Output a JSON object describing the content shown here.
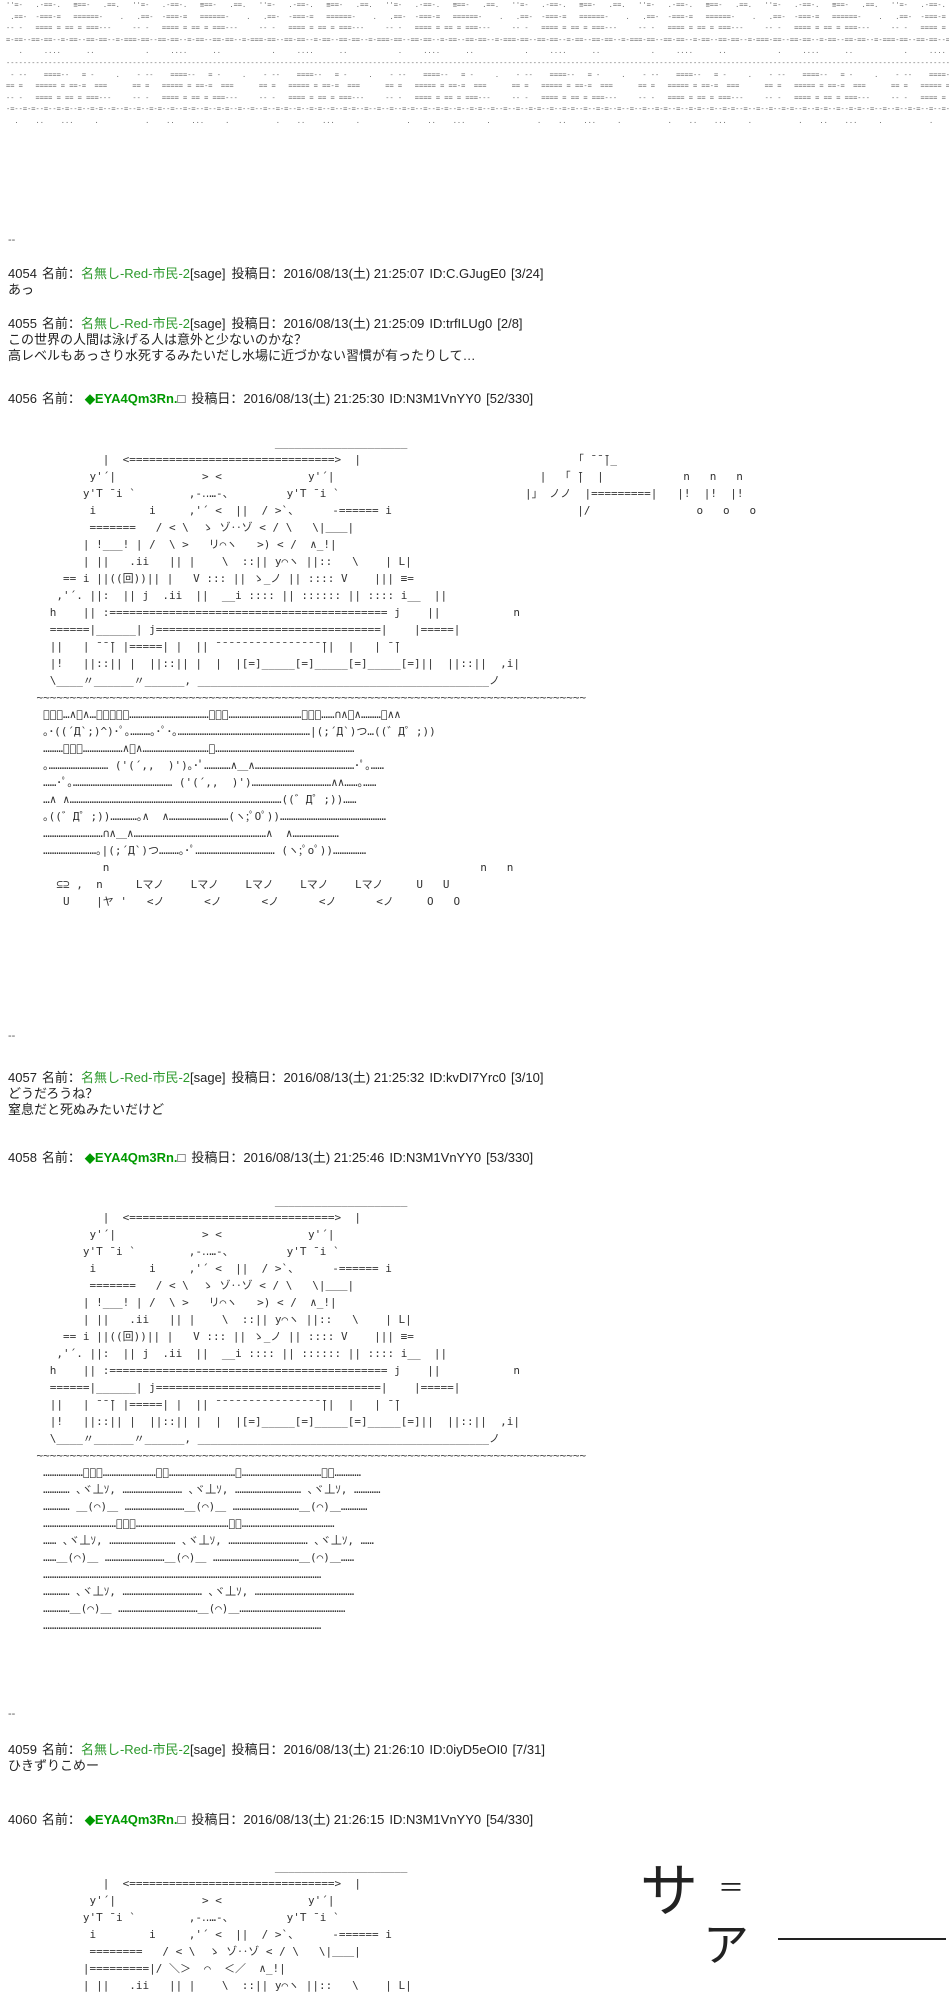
{
  "labels": {
    "name": "名前：",
    "date": "投稿日："
  },
  "separator": "--",
  "colors": {
    "name_green": "#2d9a2d",
    "trip_green": "#009900",
    "text": "#222222",
    "aa": "#333333",
    "background": "#ffffff"
  },
  "top_overflow_aa": "''=-   .-==-.   ≡==-   .==.   ''=-   .-==-.   ≡==-   .==.   ''=-   .-==-.   ≡==-   .==.   ''=-   .-==-.   ≡==-   .==.   ''=-   .-==-.   ≡==-   .==.   ''=-   .-==-.   ≡==-   .==.   ''=-   .-==-.   ≡==-   .==.   ''=-   .-==-.   ≡==-   .==.   \n .==-  -===-=   ======-    .   .==-  -===-=   ======-    .   .==-  -===-=   ======-    .   .==-  -===-=   ======-    .   .==-  -===-=   ======-    .   .==-  -===-=   ======-    .   .==-  -===-=   ======-    .   .==-  -===-=   ======-    .  \n-- -   ==== = == = ===---     -- -   ==== = == = ===---     -- -   ==== = == = ===---     -- -   ==== = == = ===---     -- -   ==== = == = ===---     -- -   ==== = == = ===---     -- -   ==== = == = ===---     -- -   ==== = == = ===---     \n=-==--==-==--=-==--==-==--=-===-==--==-==--=-==--==-==--=-===-==--==-==--=-==--==-==--=-===-==--==-==--=-==--==-==--=-===-==--==-==--=-==--==-==--=-===-==--==-==--=-==--==-==--=-===-==--==-==--=-==--==-==--=-===-==--==-==--=-==--==-==--=-==\n   .     ....      ..            .     ....      ..            .     ....      ..            .     ....      ..            .     ....      ..            .     ....      ..            .     ....      ..            .     ....      ..         \n------------------------------------------------------------------------------------------------------------------------------------------------------------------------------------------------------------------------------------------------\n - --    ====--   = -     .    - --    ====--   = -     .    - --    ====--   = -     .    - --    ====--   = -     .    - --    ====--   = -     .    - --    ====--   = -     .    - --    ====--   = -     .    - --    ====--   = -     .   \n== =   ===== = ==-=  ===      == =   ===== = ==-=  ===      == =   ===== = ==-=  ===      == =   ===== = ==-=  ===      == =   ===== = ==-=  ===      == =   ===== = ==-=  ===      == =   ===== = ==-=  ===      == =   ===== = ==-=  ===      \n-- -   ==== = == = ===---     -- -   ==== = == = ===---     -- -   ==== = == = ===---     -- -   ==== = == = ===---     -- -   ==== = == = ===---     -- -   ==== = == = ===---     -- -   ==== = == = ===---     -- -   ==== = == = ===---     \n-=--=-=--=--=-=--=--=-=--=--=--=--=-=--=--=-=--=--=-=--=--=--=--=-=--=--=-=--=--=-=--=--=--=--=-=--=--=-=--=--=-=--=--=--=--=-=--=--=-=--=--=-=--=--=--=--=-=--=--=-=--=--=-=--=--=--=--=-=--=--=-=--=--=-=--=--=--=--=-=--=--=-=--=--=-=--=--\n  .    ..    ...     .           .    ..    ...     .           .    ..    ...     .           .    ..    ...     .           .    ..    ...     .           .    ..    ...     .           .    ..    ...     .           .    ..    ...     .  ",
  "posts": [
    {
      "number": "4054",
      "name": "名無し-Red-市民-2",
      "name_suffix": "[sage]",
      "datetime": "2016/08/13(土) 21:25:07",
      "id": "ID:C.GJugE0",
      "count": "[3/24]",
      "body": "あっ"
    },
    {
      "number": "4055",
      "name": "名無し-Red-市民-2",
      "name_suffix": "[sage]",
      "datetime": "2016/08/13(土) 21:25:09",
      "id": "ID:trfILUg0",
      "count": "[2/8]",
      "body": "この世界の人間は泳げる人は意外と少ないのかな？\n高レベルもあっさり水死するみたいだし水場に近づかない習慣が有ったりして…"
    },
    {
      "number": "4056",
      "name": "◆EYA4Qm3Rn.",
      "name_suffix": "□",
      "datetime": "2016/08/13(土) 21:25:30",
      "id": "ID:N3M1VnYY0",
      "count": "[52/330]",
      "body": "                                        ____________________\n              |  <===============================>  |                                「 ̄ ̄ ̄|_\n            y'´|             > <             y'´|                               |  「 ̄|  |            n   n   n\n           y'T ̄ i `        ,-‥…-、        y'T ̄ i `                            |」 ノノ  |=========|   |!  |!  |!\n            i        i     ,'´ <  ||  / >`、     -====== i                            |/                o   o   o\n            =======   / < \\  ゝ ゾ‥ゾ < / \\   \\|＿＿|\n           | !___! | /  \\ >   リ⌒ヽ   >) < /  ∧_!|\n           | ||   .ii   || |    \\  ::|| y⌒ヽ ||::   \\    | L|\n        == i ||((回))|| |   V ::: || ゝ_ノ || :::: V    ||| ≡=\n       ,'´. ||:  || j  .ii  ||  __i :::: || :::::: || :::: i__  ||\n      h    || :========================================== j    ||           n\n      ======|______| j==================================|    |=====|\n      ||   | ̄ ̄ ̄| |=====| |  || ̄ ̄ ̄ ̄ ̄ ̄ ̄ ̄ ̄ ̄ ̄ ̄ ̄ ̄ ̄ ̄ ̄||  |   | ̄ ̄|\n      |!   ||::|| |  ||::|| |  |  |[=]_____[=]_____[=]_____[=]||  ||::||  ,i|\n      \\____〃______〃______, ____________________________________________ノ\n    ~~~~~~~~~~~~~~~~~~~~~~~~~~~~~~~~~~~~~~~~~~~~~~~~~~~~~~~~~~~~~~~~~~~~~~~~~~~~~~~~~~~\n     ﾟ･｡…∧＿∧…｡･ﾟﾟ･………………………………｡･ﾟ……………………………｡･ﾟ……∩∧＿∧………．∧∧\n     ｡･((´Д`;)^)･ﾟ｡………｡･ﾟ･｡……………………………………………………|(;´Д`)つ…((゛Д゜;))\n     ………ﾟ･｡………………∧＿∧…………………………｡………………………………………………………\n     ｡……………………… ('(´,,  )')｡･ﾟ…………∧＿∧………………………………………･ﾟ｡……\n     ……･ﾟ｡……………………………………… ('(´,,  )')………………………………∧∧……｡……\n     …∧ ∧……………………………………………………………………………………((゛Д゜;))……\n     ｡((゛Д゜;))…………｡∧  ∧………………………(ヽ;ﾟOﾟ))…………………………………………\n     ………………………∩∧＿∧……………………………………………………∧  ∧…………………\n     ……………………｡|(;´Д`)つ………｡･ﾟ……………………………… (ヽ;ﾟoﾟ))……………\n              n                                                        n   n\n       ⊆⊇ ,  n     Lマノ    Lマノ    Lマノ    Lマノ    Lマノ     U   U\n        U    |ヤ '   <ノ      <ノ      <ノ      <ノ      <ノ     O   O"
    },
    {
      "number": "4057",
      "name": "名無し-Red-市民-2",
      "name_suffix": "[sage]",
      "datetime": "2016/08/13(土) 21:25:32",
      "id": "ID:kvDI7Yrc0",
      "count": "[3/10]",
      "body": "どうだろうね？\n窒息だと死ぬみたいだけど"
    },
    {
      "number": "4058",
      "name": "◆EYA4Qm3Rn.",
      "name_suffix": "□",
      "datetime": "2016/08/13(土) 21:25:46",
      "id": "ID:N3M1VnYY0",
      "count": "[53/330]",
      "body": "                                        ____________________\n              |  <===============================>  |\n            y'´|             > <             y'´|\n           y'T ̄ i `        ,-‥…-、        y'T ̄ i `\n            i        i     ,'´ <  ||  / >`、     -====== i\n            =======   / < \\  ゝ ゾ‥ゾ < / \\   \\|＿＿|\n           | !___! | /  \\ >   リ⌒ヽ   >) < /  ∧_!|\n           | ||   .ii   || |    \\  ::|| y⌒ヽ ||::   \\    | L|\n        == i ||((回))|| |   V ::: || ゝ_ノ || :::: V    ||| ≡=\n       ,'´. ||:  || j  .ii  ||  __i :::: || :::::: || :::: i__  ||\n      h    || :========================================== j    ||           n\n      ======|______| j==================================|    |=====|\n      ||   | ̄ ̄ ̄| |=====| |  || ̄ ̄ ̄ ̄ ̄ ̄ ̄ ̄ ̄ ̄ ̄ ̄ ̄ ̄ ̄ ̄ ̄||  |   | ̄ ̄|\n      |!   ||::|| |  ||::|| |  |  |[=]_____[=]_____[=]_____[=]||  ||::||  ,i|\n      \\____〃______〃______, ____________________________________________ノ\n    ~~~~~~~~~~~~~~~~~~~~~~~~~~~~~~~~~~~~~~~~~~~~~~~~~~~~~~~~~~~~~~~~~~~~~~~~~~~~~~~~~~~\n     ………………ﾟ･｡……………………･ﾟ…………………………｡………………………………･ﾟ…………\n     ………… ､ヾ丄ｿ, ……………………… ､ヾ丄ｿ, ………………………… ､ヾ丄ｿ, …………\n     ………… ＿(⌒)＿ ………………………＿(⌒)＿ …………………………＿(⌒)＿…………\n     ……………………………ﾟ･｡……………………………………･ﾟ……………………………………\n     …… ､ヾ丄ｿ, ………………………… ､ヾ丄ｿ, ……………………………… ､ヾ丄ｿ, ……\n     ……＿(⌒)＿ ………………………＿(⌒)＿ …………………………………＿(⌒)＿……\n     ………………………………………………………………………………………………………………\n     ………… ､ヾ丄ｿ, ……………………………… ､ヾ丄ｿ, ………………………………………\n     …………＿(⌒)＿ ………………………………＿(⌒)＿…………………………………………\n     ………………………………………………………………………………………………………………"
    },
    {
      "number": "4059",
      "name": "名無し-Red-市民-2",
      "name_suffix": "[sage]",
      "datetime": "2016/08/13(土) 21:26:10",
      "id": "ID:0iyD5eOI0",
      "count": "[7/31]",
      "body": "ひきずりこめー"
    },
    {
      "number": "4060",
      "name": "◆EYA4Qm3Rn.",
      "name_suffix": "□",
      "datetime": "2016/08/13(土) 21:26:15",
      "id": "ID:N3M1VnYY0",
      "count": "[54/330]",
      "body": "                                        ____________________\n              |  <===============================>  |\n            y'´|             > <             y'´|\n           y'T ̄ i `        ,-‥…-、        y'T ̄ i `\n            i        i     ,'´ <  ||  / >`、     -====== i\n            ========   / < \\  ゝ ゾ‥ゾ < / \\   \\|＿＿|\n           |=========|/ ＼＞  ⌒  ＜／  ∧_!|\n           | ||   .ii   || |    \\  ::|| y⌒ヽ ||::   \\    | L|"
    }
  ],
  "splash_art": {
    "sa": "サ",
    "eq": "＝",
    "a": "ア"
  }
}
